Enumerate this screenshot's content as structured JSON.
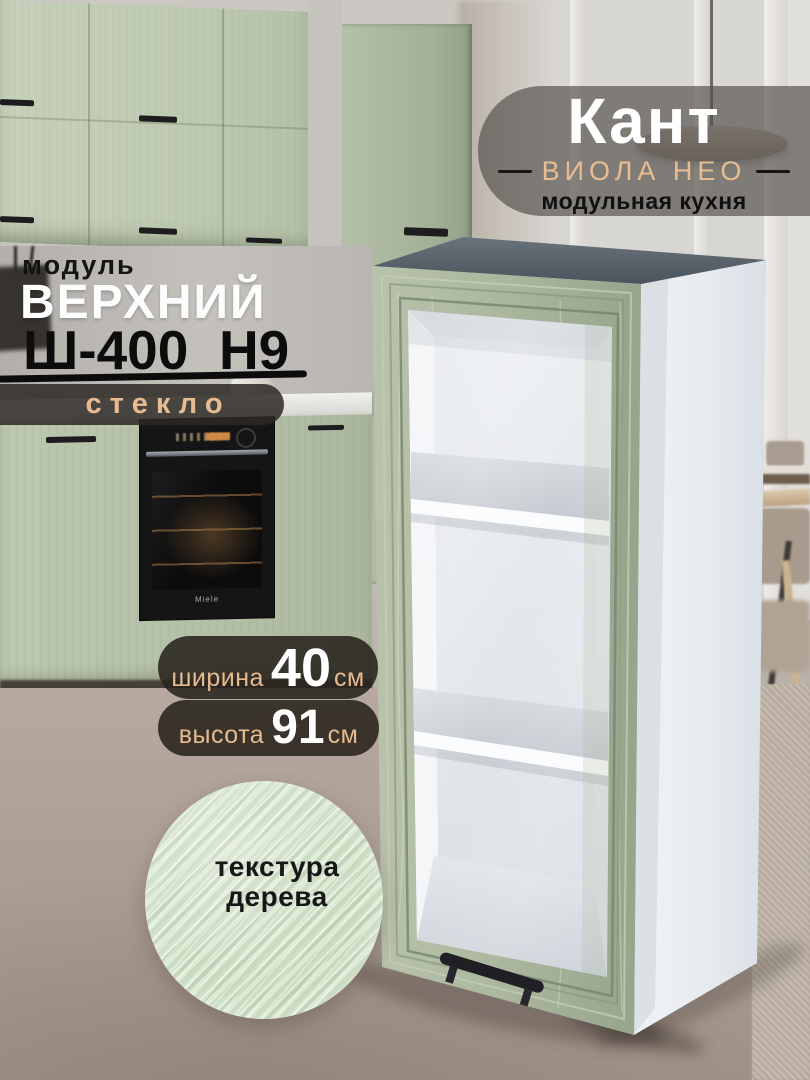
{
  "brand": {
    "name": "Кант",
    "series": "ВИОЛА НЕО",
    "tagline": "модульная кухня"
  },
  "product": {
    "category": "модуль",
    "type": "ВЕРХНИЙ",
    "model": "Ш-400_Н9",
    "feature_badge": "стекло"
  },
  "badges": {
    "width": {
      "label": "ширина",
      "value": "40",
      "unit": "см"
    },
    "height": {
      "label": "высота",
      "value": "91",
      "unit": "см"
    }
  },
  "texture_swatch": {
    "line1": "текстура",
    "line2": "дерева"
  },
  "kitchen": {
    "oven_brand": "Miele"
  },
  "colors": {
    "accent_peach": "#e9bd92",
    "facade_green": "#aeb9a2",
    "overlay_dark": "rgba(40,35,29,0.88)",
    "cabinet_top_gray": "#545e66",
    "side_panel_white": "#e9edf1",
    "floor_taupe": "#ab9d94"
  }
}
